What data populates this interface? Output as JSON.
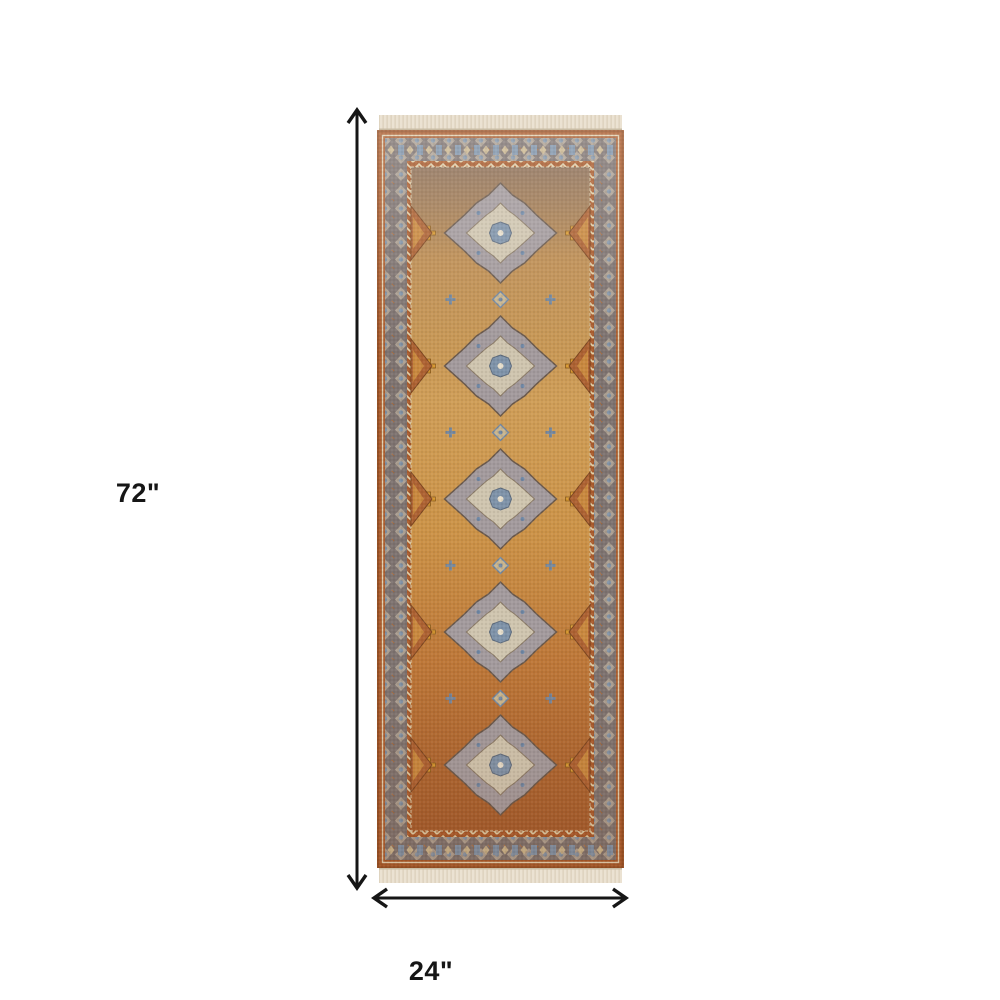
{
  "diagram": {
    "height_label": "72\"",
    "width_label": "24\"",
    "line_color": "#161616",
    "background": "#ffffff"
  },
  "rug": {
    "name": "Persian style runner rug with fringe",
    "palette": {
      "fringe_cream": "#ebe2d2",
      "outer_rust_border": "#a85a2b",
      "ornate_border_band": "#7e7370",
      "band_motif_cream": "#cfc2ab",
      "band_motif_blue": "#7e92a8",
      "field_gold": "#cf9a50",
      "field_rust": "#b06a33",
      "medallion_gray": "#a39a9d",
      "medallion_cream": "#cfc5af",
      "accent_blue": "#7f93a9",
      "accent_gold": "#d99a33"
    }
  }
}
